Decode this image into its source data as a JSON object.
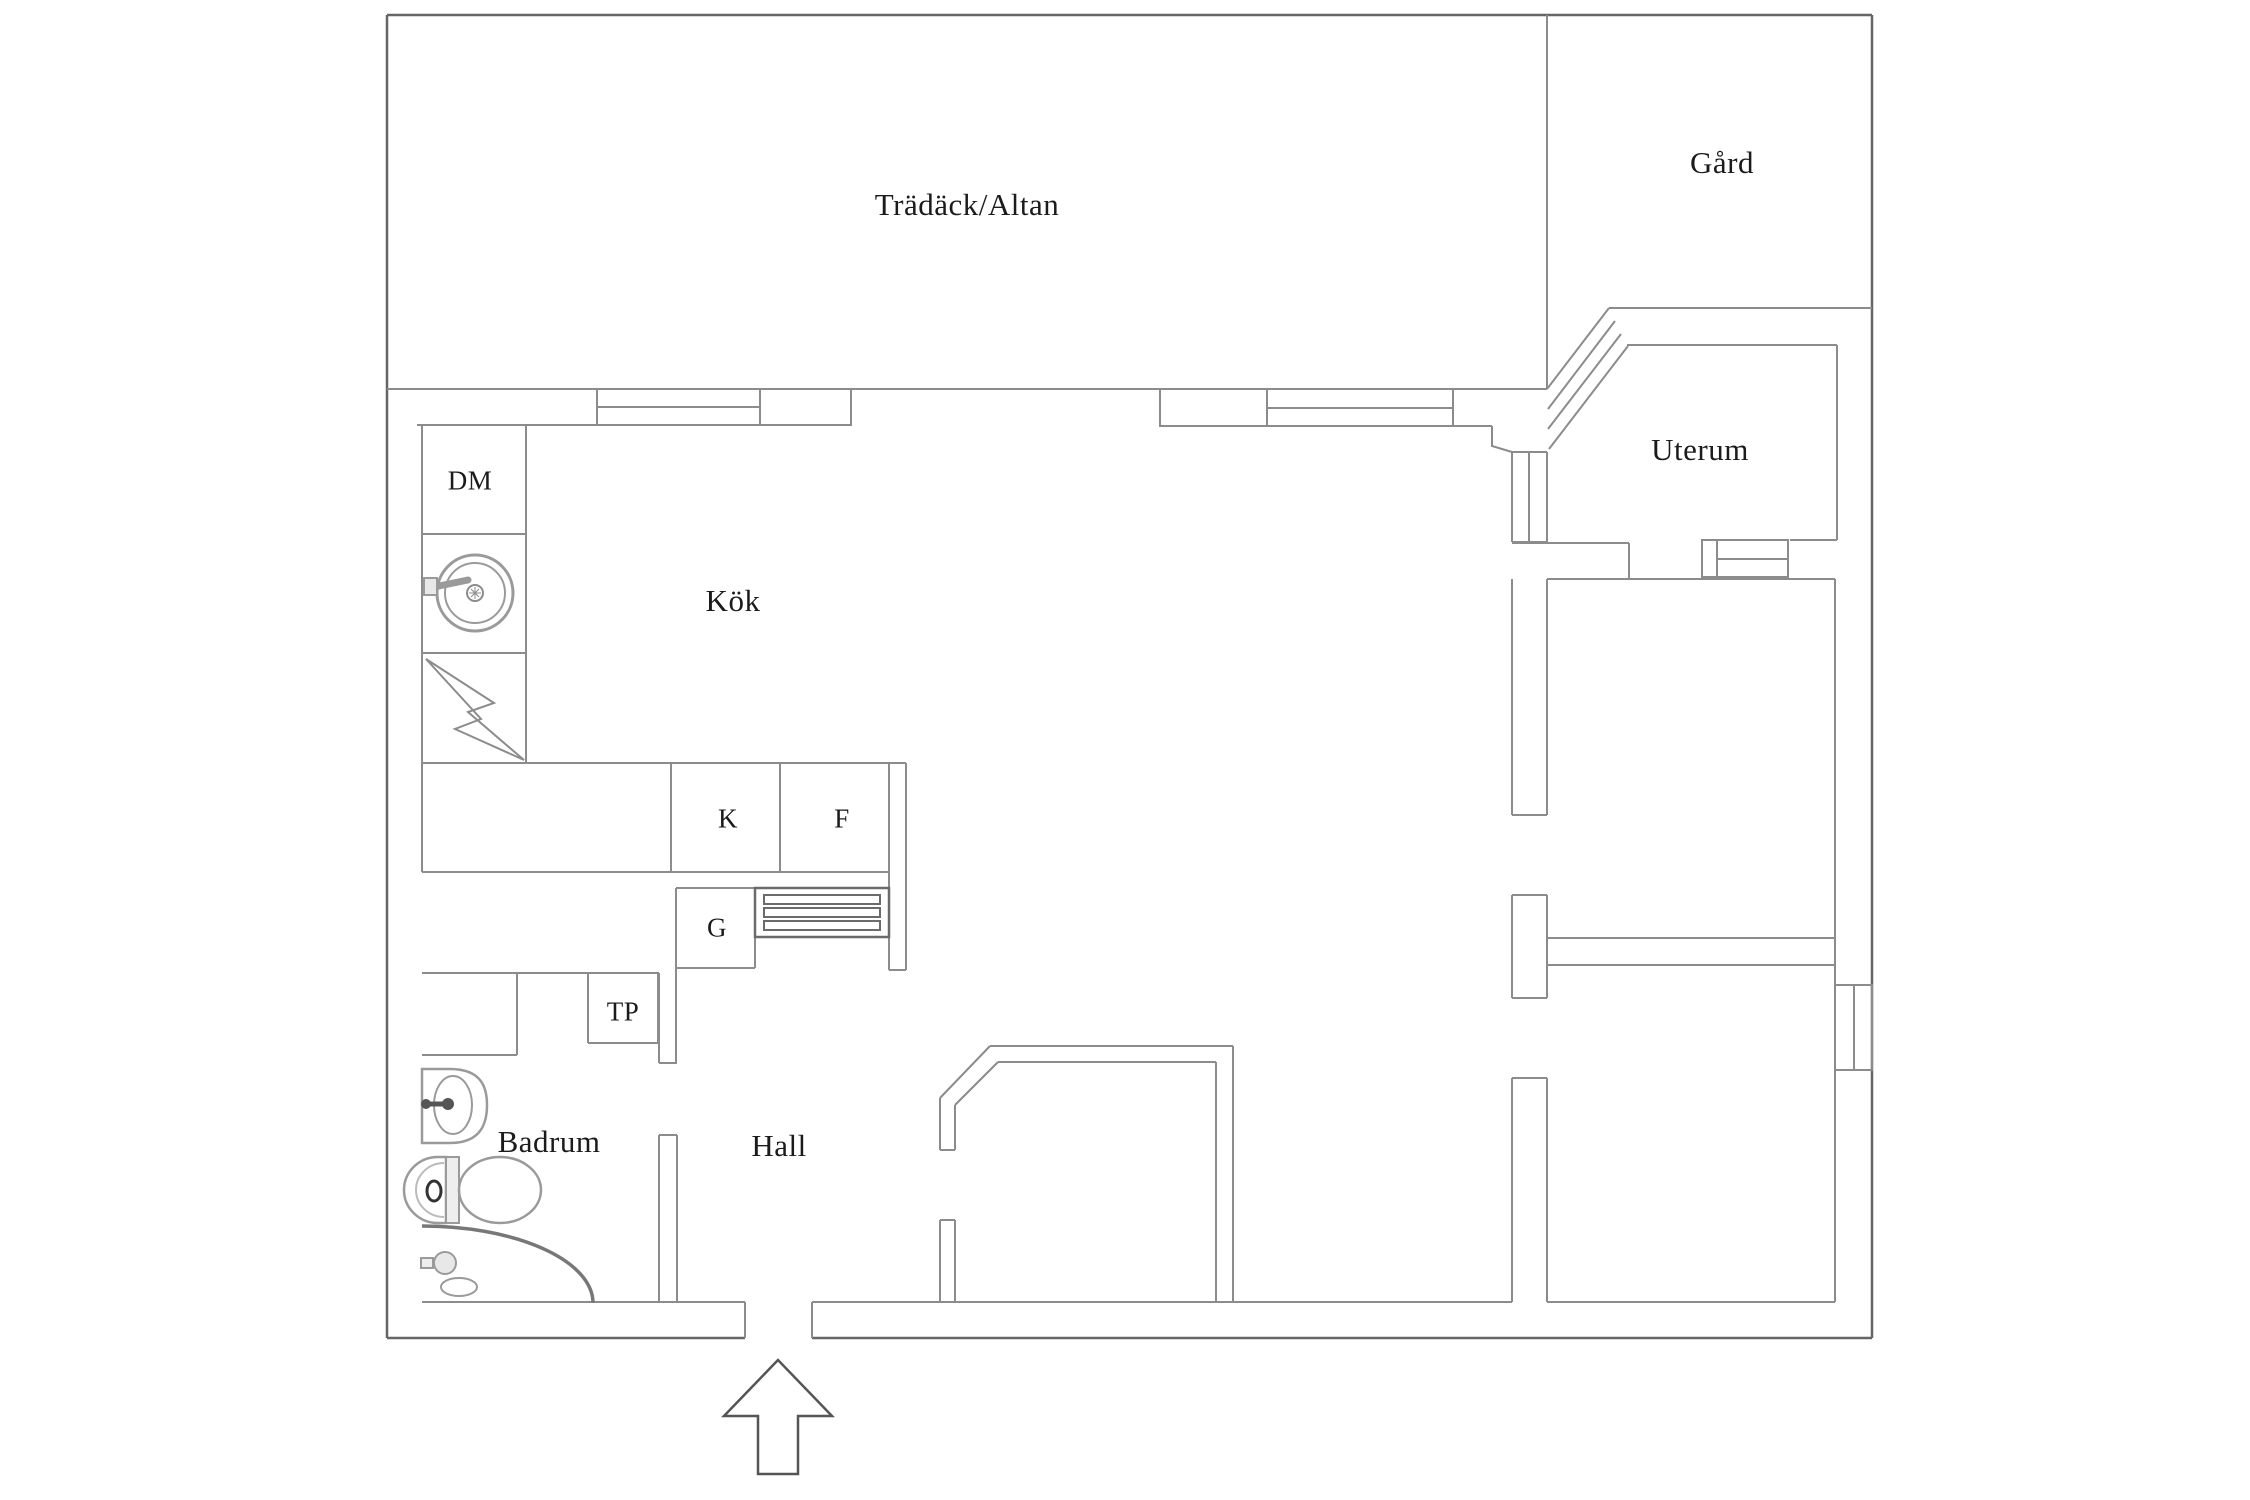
{
  "floorplan": {
    "canvas": {
      "width": 2250,
      "height": 1500
    },
    "rooms": [
      {
        "id": "tradack-altan",
        "label": "Trädäck/Altan",
        "x": 967,
        "y": 205,
        "size": "large"
      },
      {
        "id": "gard",
        "label": "Gård",
        "x": 1722,
        "y": 163,
        "size": "large"
      },
      {
        "id": "uterum",
        "label": "Uterum",
        "x": 1700,
        "y": 450,
        "size": "large"
      },
      {
        "id": "kok",
        "label": "Kök",
        "x": 733,
        "y": 601,
        "size": "large"
      },
      {
        "id": "dm",
        "label": "DM",
        "x": 470,
        "y": 481,
        "size": "small"
      },
      {
        "id": "k",
        "label": "K",
        "x": 728,
        "y": 819,
        "size": "small"
      },
      {
        "id": "f",
        "label": "F",
        "x": 842,
        "y": 819,
        "size": "small"
      },
      {
        "id": "g",
        "label": "G",
        "x": 717,
        "y": 928,
        "size": "small"
      },
      {
        "id": "tp",
        "label": "TP",
        "x": 623,
        "y": 1012,
        "size": "small"
      },
      {
        "id": "badrum",
        "label": "Badrum",
        "x": 549,
        "y": 1142,
        "size": "large"
      },
      {
        "id": "hall",
        "label": "Hall",
        "x": 779,
        "y": 1146,
        "size": "large"
      }
    ],
    "fixtures": [
      {
        "name": "dishwasher-cell"
      },
      {
        "name": "kitchen-sink-icon"
      },
      {
        "name": "stove-lightning-icon"
      },
      {
        "name": "fridge-cell"
      },
      {
        "name": "freezer-cell"
      },
      {
        "name": "grille-hatch-icon"
      },
      {
        "name": "washbasin-icon"
      },
      {
        "name": "toilet-icon"
      },
      {
        "name": "corner-shower-icon"
      },
      {
        "name": "entrance-arrow-icon"
      }
    ],
    "colors": {
      "background": "#ffffff",
      "wall": "#8c8c8c",
      "outer_wall": "#666666",
      "bold_detail": "#6b6b6b",
      "fixture": "#9a9a9a",
      "text": "#1b1b1b"
    }
  }
}
